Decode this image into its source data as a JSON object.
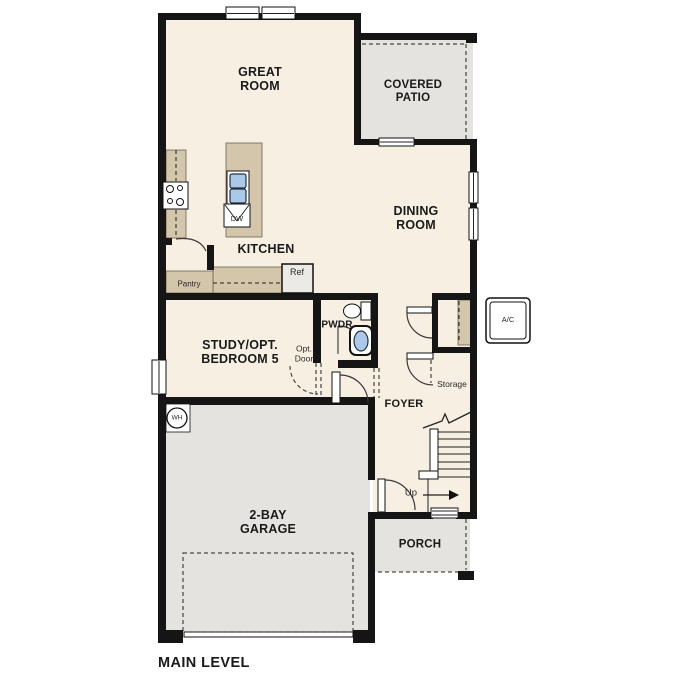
{
  "title": "MAIN LEVEL",
  "colors": {
    "wall": "#151515",
    "floor": "#f6efe2",
    "ext": "#e4e3e0",
    "tan": "#d3c6ab",
    "blue": "#abc8e8",
    "text": "#1a1a1a"
  },
  "rooms": {
    "great_room": "GREAT\nROOM",
    "covered_patio": "COVERED\nPATIO",
    "dining_room": "DINING\nROOM",
    "kitchen": "KITCHEN",
    "study": "STUDY/OPT.\nBEDROOM 5",
    "pwdr": "PWDR",
    "foyer": "FOYER",
    "garage": "2-BAY\nGARAGE",
    "porch": "PORCH"
  },
  "fixtures": {
    "pantry": "Pantry",
    "ref": "Ref",
    "dw": "DW",
    "wh": "WH",
    "ac": "A/C",
    "storage": "Storage",
    "opt_door": "Opt.\nDoor",
    "up": "Up"
  }
}
